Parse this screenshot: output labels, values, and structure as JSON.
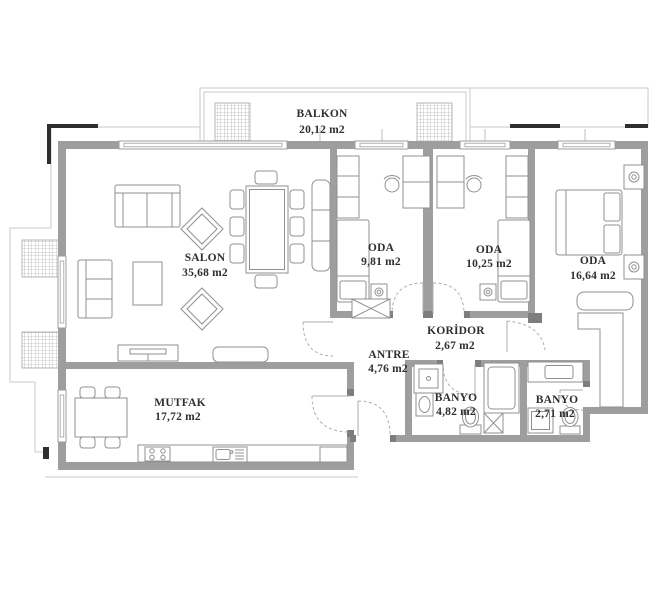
{
  "plan": {
    "kind": "apartment floor plan",
    "rooms": {
      "balkon": {
        "name": "BALKON",
        "area": "20,12 m2"
      },
      "salon": {
        "name": "SALON",
        "area": "35,68 m2"
      },
      "oda1": {
        "name": "ODA",
        "area": "9,81 m2"
      },
      "oda2": {
        "name": "ODA",
        "area": "10,25 m2"
      },
      "oda3": {
        "name": "ODA",
        "area": "16,64 m2"
      },
      "koridor": {
        "name": "KORİDOR",
        "area": "2,67 m2"
      },
      "antre": {
        "name": "ANTRE",
        "area": "4,76 m2"
      },
      "mutfak": {
        "name": "MUTFAK",
        "area": "17,72 m2"
      },
      "banyo1": {
        "name": "BANYO",
        "area": "4,82 m2"
      },
      "banyo2": {
        "name": "BANYO",
        "area": "2,71 m2"
      }
    },
    "colors": {
      "wall": "#9e9e9e",
      "furniture": "#909090",
      "facade_outline": "#c9c9c9",
      "facade_marks": "#2f2f2f",
      "label_text": "#2f2f2f",
      "background": "#ffffff"
    }
  }
}
